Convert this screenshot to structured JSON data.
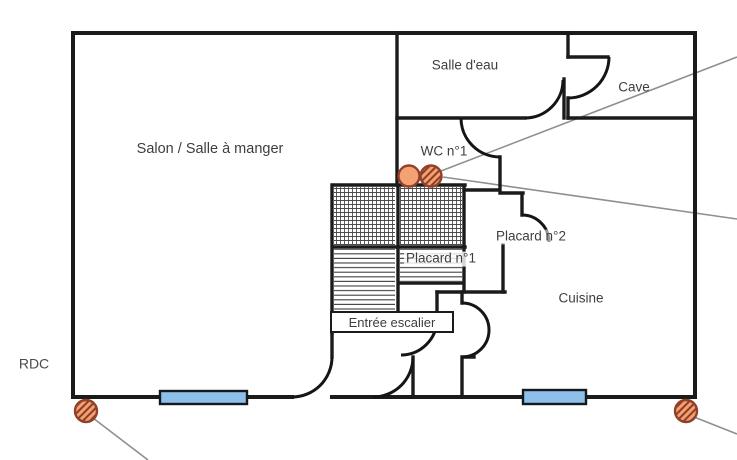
{
  "floor": {
    "label": "RDC"
  },
  "rooms": {
    "salon": {
      "label": "Salon / Salle à manger"
    },
    "salle_deau": {
      "label": "Salle d'eau"
    },
    "cave": {
      "label": "Cave"
    },
    "wc": {
      "label": "WC n°1"
    },
    "placard1": {
      "label": "Placard n°1"
    },
    "placard2": {
      "label": "Placard n°2"
    },
    "entree": {
      "label": "Entrée escalier"
    },
    "cuisine": {
      "label": "Cuisine"
    }
  },
  "markers": {
    "wc_plain": {
      "type": "detector-round-plain",
      "location": "next to WC n°1 door"
    },
    "wc_hatched": {
      "type": "detector-round-hatched",
      "location": "next to WC n°1 door"
    },
    "bottom_left": {
      "type": "detector-round-hatched",
      "location": "bottom-left corner of plan"
    },
    "bottom_right": {
      "type": "detector-round-hatched",
      "location": "bottom-right corner of plan"
    }
  },
  "windows": {
    "count": 2,
    "location": "bottom outer wall"
  },
  "colors": {
    "wall": "#1b1b1b",
    "window_fill": "#8cc0ea",
    "marker_fill": "#f3a273",
    "marker_border": "#93402a",
    "marker_hatch": "#8a3a22",
    "leader_line": "#8f8f8f",
    "label_text": "#3e3e3e"
  }
}
